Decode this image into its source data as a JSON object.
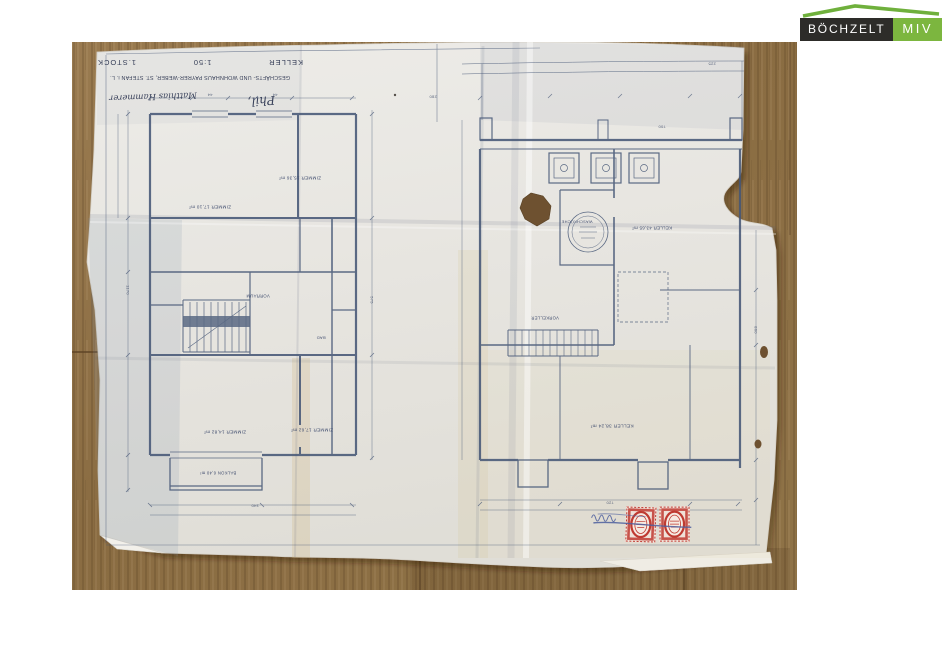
{
  "logo": {
    "brand_left": "BÖCHZELT",
    "brand_right": "MIV",
    "roof_color": "#6fb03c",
    "left_bg": "#2d2c29",
    "right_bg": "#7cb63f"
  },
  "photo": {
    "wood_base": "#96784b",
    "paper_color": "#e8e6e0",
    "ink_color": "#475877",
    "stamp_color": "#bf3a31",
    "stamp_overprint_color": "#4d5f9e"
  },
  "titleblock": {
    "plan_left_name": "KELLER",
    "scale": "1:50",
    "plan_right_name": "1.STOCK",
    "project": "GESCHÄFTS- UND WOHNHAUS PAYRER-WEBER, ST. STEFAN i. L.",
    "signature_1": "Phil,",
    "signature_2": "Matthias Hammerer"
  },
  "annotations": [
    {
      "t": "ZIMMER 17,10 m²",
      "x": 210,
      "y": 207,
      "s": 4.6,
      "r": 180,
      "k": "label"
    },
    {
      "t": "ZIMMER 15,36 m²",
      "x": 300,
      "y": 178,
      "s": 4.6,
      "r": 180,
      "k": "label"
    },
    {
      "t": "VORRAUM",
      "x": 258,
      "y": 296,
      "s": 4.2,
      "r": 180,
      "k": "label"
    },
    {
      "t": "BAD",
      "x": 321,
      "y": 338,
      "s": 4,
      "r": 180,
      "k": "label"
    },
    {
      "t": "ZIMMER 14,82 m²",
      "x": 225,
      "y": 432,
      "s": 4.6,
      "r": 180,
      "k": "label"
    },
    {
      "t": "ZIMMER 17,62 m²",
      "x": 312,
      "y": 430,
      "s": 4.6,
      "r": 180,
      "k": "label"
    },
    {
      "t": "BALKON 6,40 m²",
      "x": 218,
      "y": 473,
      "s": 4.2,
      "r": 180,
      "k": "label"
    },
    {
      "t": "WASCHKÜCHE",
      "x": 577,
      "y": 222,
      "s": 3.9,
      "r": 180,
      "k": "label"
    },
    {
      "t": "KELLER 43,65 m²",
      "x": 652,
      "y": 228,
      "s": 4.4,
      "r": 180,
      "k": "label"
    },
    {
      "t": "VORKELLER",
      "x": 545,
      "y": 318,
      "s": 4.2,
      "r": 180,
      "k": "label"
    },
    {
      "t": "KELLER 38,24 m²",
      "x": 612,
      "y": 425,
      "s": 4.8,
      "r": 180,
      "k": "label"
    },
    {
      "t": "44",
      "x": 210,
      "y": 95,
      "s": 4,
      "r": 180,
      "k": "dim"
    },
    {
      "t": "44",
      "x": 275,
      "y": 95,
      "s": 4,
      "r": 180,
      "k": "dim"
    },
    {
      "t": "280",
      "x": 433,
      "y": 97,
      "s": 4,
      "r": 180,
      "k": "dim"
    },
    {
      "t": "700",
      "x": 662,
      "y": 127,
      "s": 4,
      "r": 180,
      "k": "dim"
    },
    {
      "t": "225",
      "x": 712,
      "y": 64,
      "s": 4,
      "r": 180,
      "k": "dim"
    },
    {
      "t": "575",
      "x": 372,
      "y": 300,
      "s": 4,
      "r": 90,
      "k": "dim"
    },
    {
      "t": "1170",
      "x": 128,
      "y": 290,
      "s": 4,
      "r": 90,
      "k": "dim"
    },
    {
      "t": "860",
      "x": 756,
      "y": 330,
      "s": 4,
      "r": 90,
      "k": "dim"
    },
    {
      "t": "340",
      "x": 255,
      "y": 506,
      "s": 4,
      "r": 180,
      "k": "dim"
    },
    {
      "t": "720",
      "x": 610,
      "y": 503,
      "s": 4,
      "r": 180,
      "k": "dim"
    }
  ]
}
